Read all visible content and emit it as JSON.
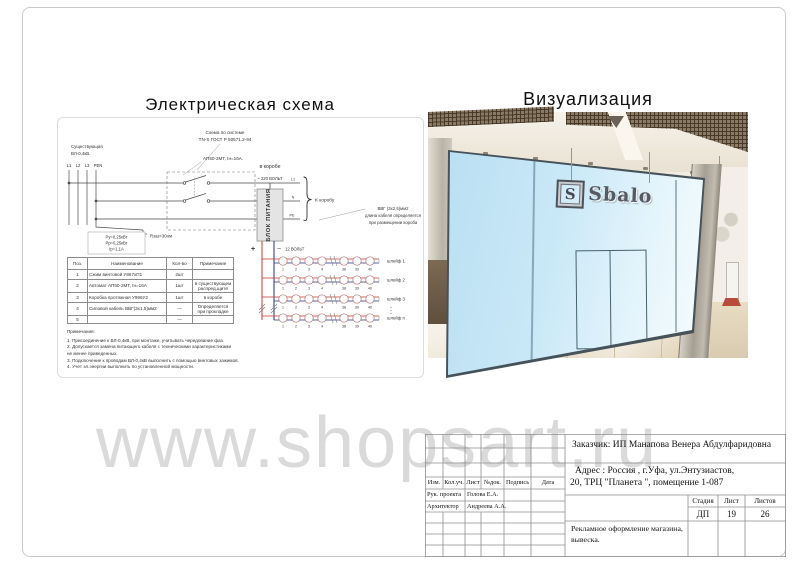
{
  "sheet": {
    "watermark": "www.shopsart.ru"
  },
  "schematic_panel": {
    "title": "Электрическая схема",
    "system_note": [
      "Схема по системе",
      "TN-S ГОСТ Р 50571.2-94"
    ],
    "existing_line": [
      "Существующая",
      "ВЛ-0,4кВ."
    ],
    "breaker": "АП50-2МТ, Iн=16А.",
    "buses": [
      "L1",
      "L2",
      "L3",
      "PEN"
    ],
    "outputs": [
      "L1",
      "N",
      "PE"
    ],
    "to_duct": "К коробу",
    "cable_note": [
      "ВВГ (3х2,5)мм2",
      "длина кабеля определяется",
      "при размещении короба"
    ],
    "ground": "Rзаз<30ом",
    "load_box": [
      "Pу=0,25кВт",
      "Pр=0,25кВт",
      "Iр=1,1А"
    ],
    "table": {
      "headers": [
        "Поз.",
        "Наименование",
        "Кол-во",
        "Примечание"
      ],
      "rows": [
        {
          "pos": "1",
          "name": "Сжим винтовой У867хП1",
          "qty": "2шт",
          "note": ""
        },
        {
          "pos": "2",
          "name": "Автомат АП50-2МТ, Iн=16А",
          "qty": "1шт",
          "note": "в существующем распред.щите"
        },
        {
          "pos": "3",
          "name": "Коробка протяжная У996У2",
          "qty": "1шт",
          "note": "в коробе"
        },
        {
          "pos": "4",
          "name": "Силовой кабель ВВГ(3х1,5)мм2",
          "qty": "—",
          "note": "Определяется при прокладке"
        },
        {
          "pos": "5",
          "name": "",
          "qty": "—",
          "note": ""
        }
      ]
    },
    "notes_title": "Примечания:",
    "notes": [
      "1. Присоединение к ВЛ-0,4кВ, при монтаже, учитывать чередование фаз.",
      "2. Допускается замена питающего кабеля с техническими характеристиками",
      "не менее приведенных.",
      "3. Подключение к проводам ВЛ-0,4кВ выполнить с помощью винтовых зажимов.",
      "4. Учет эл.энергии выполнить по установленной мощности."
    ],
    "power": {
      "duct": "в коробе",
      "input": "~ 220 ВОЛЬТ",
      "psu": "БЛОК ПИТАНИЯ",
      "plus": "+",
      "minus": "−",
      "output": "12 ВОЛЬТ",
      "chain_labels": [
        "шлейф 1",
        "шлейф 2",
        "шлейф 3",
        "шлейф n"
      ],
      "module_numbers": [
        "1",
        "2",
        "3",
        "4",
        "38",
        "39",
        "40"
      ]
    }
  },
  "visualization_panel": {
    "title": "Визуализация",
    "sign": {
      "logo_letter": "S",
      "brand": "Sbalo"
    }
  },
  "title_block": {
    "customer": "Заказчик:  ИП Манапова Венера Абдулфаридовна",
    "address": [
      "Адрес : Россия , г.Уфа, ул.Энтузиастов,",
      "20, ТРЦ \"Планета \", помещение 1-087"
    ],
    "columns": [
      "Изм.",
      "Кол.уч.",
      "Лист",
      "№док.",
      "Подпись",
      "Дата"
    ],
    "rows": [
      {
        "role": "Рук. проекта",
        "name": "Голова Е.А."
      },
      {
        "role": "Архитектор",
        "name": "Андреева А.А."
      }
    ],
    "stage_label": "Стадия",
    "sheet_label": "Лист",
    "sheets_label": "Листов",
    "stage": "ДП",
    "sheet_no": "19",
    "sheets_total": "26",
    "subject": [
      "Рекламное оформление магазина,",
      "вывеска."
    ]
  }
}
